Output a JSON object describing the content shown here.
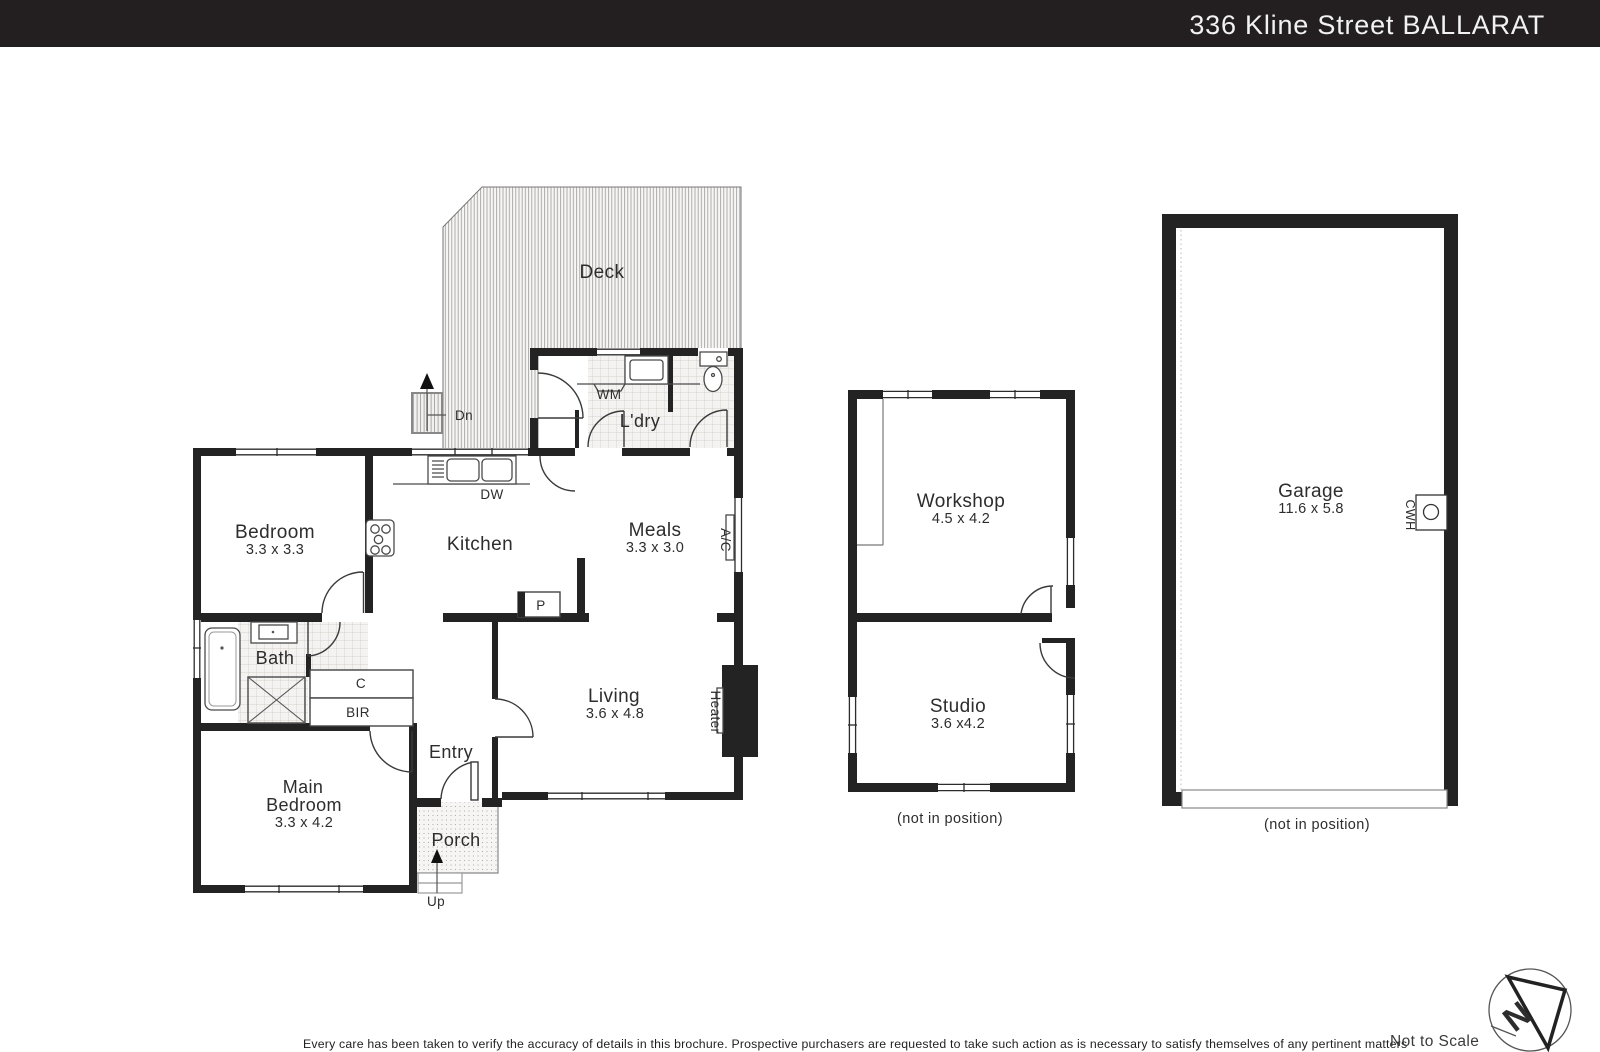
{
  "header": {
    "title": "336 Kline Street BALLARAT"
  },
  "colors": {
    "header_bg": "#231f20",
    "wall": "#232323",
    "paper": "#ffffff"
  },
  "floorplan": {
    "deck": {
      "label": "Deck"
    },
    "stairs": {
      "down": "Dn",
      "up": "Up"
    },
    "laundry": {
      "label": "L'dry",
      "washing_machine": "WM"
    },
    "kitchen": {
      "label": "Kitchen",
      "dishwasher": "DW",
      "pantry": "P"
    },
    "bedroom": {
      "label": "Bedroom",
      "dims": "3.3 x 3.3"
    },
    "meals": {
      "label": "Meals",
      "dims": "3.3 x 3.0",
      "air_conditioner": "A/C"
    },
    "bath": {
      "label": "Bath"
    },
    "cupboard": "C",
    "built_in_robe": "BIR",
    "living": {
      "label": "Living",
      "dims": "3.6 x 4.8",
      "heater": "Heater"
    },
    "entry": {
      "label": "Entry"
    },
    "porch": {
      "label": "Porch"
    },
    "main_bedroom": {
      "line1": "Main",
      "line2": "Bedroom",
      "dims": "3.3 x 4.2"
    }
  },
  "outbuilding": {
    "workshop": {
      "label": "Workshop",
      "dims": "4.5 x 4.2"
    },
    "studio": {
      "label": "Studio",
      "dims": "3.6 x4.2"
    },
    "caption": "(not in position)"
  },
  "garage": {
    "label": "Garage",
    "dims": "11.6 x 5.8",
    "hot_water_unit": "CWH",
    "caption": "(not in position)"
  },
  "compass": {
    "north": "N"
  },
  "footer": {
    "disclaimer": "Every care has been taken to verify the accuracy of details in this brochure. Prospective purchasers are requested to take such action as is necessary to satisfy themselves of any pertinent matters",
    "scale_note": "Not to Scale"
  }
}
